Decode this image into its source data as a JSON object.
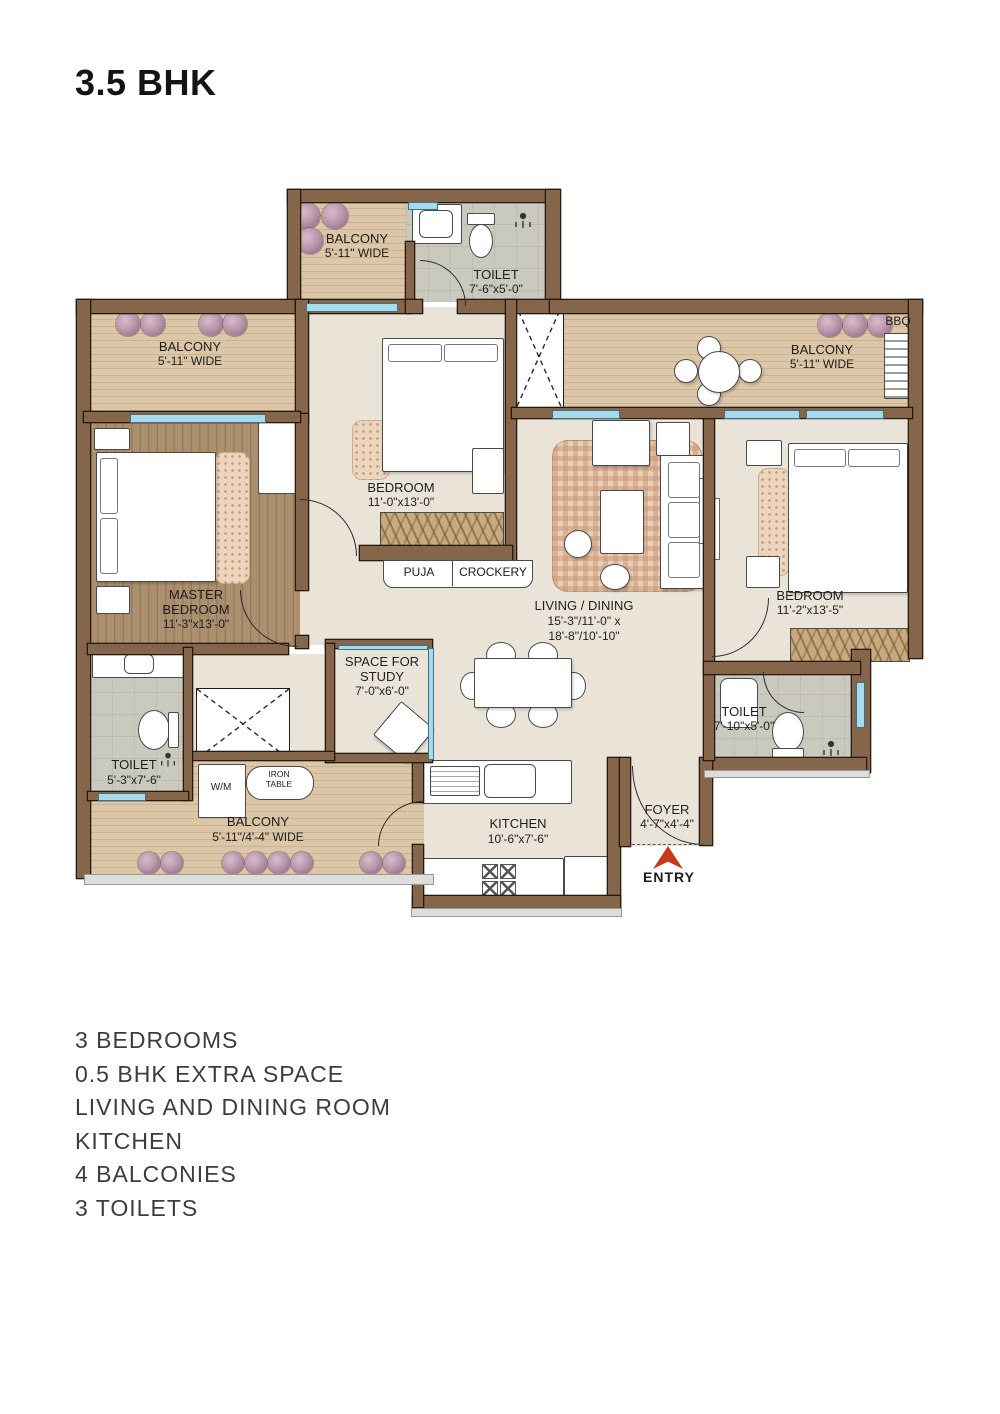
{
  "title": "3.5 BHK",
  "features": [
    "3 BEDROOMS",
    "0.5 BHK EXTRA SPACE",
    "LIVING AND DINING ROOM",
    "KITCHEN",
    "4 BALCONIES",
    "3 TOILETS"
  ],
  "rooms": {
    "balcony_top": {
      "name": "BALCONY",
      "dims": "5'-11\" WIDE"
    },
    "toilet_top": {
      "name": "TOILET",
      "dims": "7'-6\"x5'-0\""
    },
    "balcony_left": {
      "name": "BALCONY",
      "dims": "5'-11\" WIDE"
    },
    "balcony_right": {
      "name": "BALCONY",
      "dims": "5'-11\" WIDE"
    },
    "bbq_label": "BBQ",
    "bedroom_top": {
      "name": "BEDROOM",
      "dims": "11'-0\"x13'-0\""
    },
    "master_bedroom": {
      "line1": "MASTER",
      "line2": "BEDROOM",
      "dims": "11'-3\"x13'-0\""
    },
    "living_dining": {
      "name": "LIVING / DINING",
      "dims1": "15'-3\"/11'-0\" x",
      "dims2": "18'-8\"/10'-10\""
    },
    "bedroom_right": {
      "name": "BEDROOM",
      "dims": "11'-2\"x13'-5\""
    },
    "puja": "PUJA",
    "crockery": "CROCKERY",
    "study": {
      "line1": "SPACE FOR",
      "line2": "STUDY",
      "dims": "7'-0\"x6'-0\""
    },
    "toilet_left": {
      "name": "TOILET",
      "dims": "5'-3\"x7'-6\""
    },
    "toilet_right": {
      "name": "TOILET",
      "dims": "7'-10\"x5'-0\""
    },
    "wm": "W/M",
    "iron_table": {
      "line1": "IRON",
      "line2": "TABLE"
    },
    "balcony_bottom": {
      "name": "BALCONY",
      "dims": "5'-11\"/4'-4\" WIDE"
    },
    "kitchen": {
      "name": "KITCHEN",
      "dims": "10'-6\"x7'-6\""
    },
    "foyer": {
      "name": "FOYER",
      "dims": "4'-7\"x4'-4\""
    },
    "entry": "ENTRY"
  },
  "colors": {
    "wall": "#85664a",
    "wood_floor": "#d9c4a4",
    "master_wood": "#a98e6d",
    "interior_floor": "#eae4d8",
    "toilet_tile": "#c9c9be",
    "window": "#aadae9",
    "entry_arrow": "#c8381d"
  }
}
